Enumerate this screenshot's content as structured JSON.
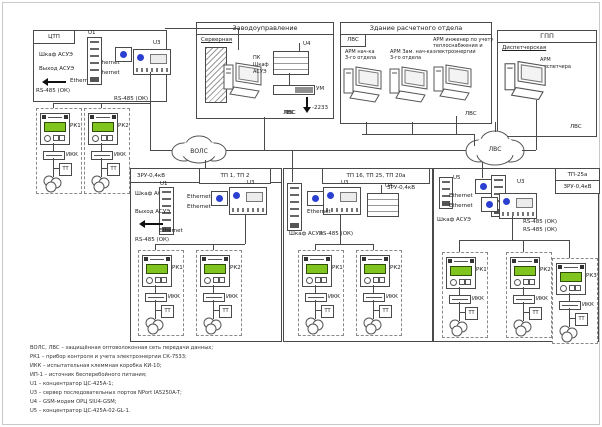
{
  "labels": {
    "ethernet": "Ethernet",
    "rs485": "RS-485 (ОК)",
    "cabinet": "Шкаф АСУЭ",
    "output": "Выход АСУЭ",
    "lvs": "ЛВС",
    "vols": "ВОЛС",
    "ikk": "ИКК",
    "tt": "ТТ",
    "pu3": "ПУ-3",
    "u1": "U1",
    "u3": "U3",
    "u4": "U4",
    "u5": "U5",
    "um": "УМ",
    "antenna": "-2233",
    "rk1": "РК1",
    "rk2": "РК2",
    "rk3": "РК3"
  },
  "boxes": {
    "ctp": {
      "title": "ЦТП"
    },
    "zavod": {
      "title": "Заводоуправление",
      "room": "Серверная",
      "pc1": "ПК",
      "pc2": "Шкаф",
      "pc3": "АСУЭ"
    },
    "raschet": {
      "title": "Здание расчетного отдела",
      "tab": "ЛВС",
      "arm1_l1": "АРМ нач-ка",
      "arm1_l2": "3-го отдела",
      "arm2_l1": "АРМ Зам. нач-ка",
      "arm2_l2": "3-го отдела",
      "arm3_l1": "АРМ инженер по учету",
      "arm3_l2": "теплоснабжения и",
      "arm3_l3": "электроэнергии"
    },
    "gpp": {
      "title": "ГПП",
      "room": "Диспетчерская",
      "arm_l1": "АРМ",
      "arm_l2": "диспетчера"
    },
    "tp12": {
      "title": "ТП 1, ТП 2",
      "zru": "ЗРУ-0,4кВ"
    },
    "tp16": {
      "title": "ТП 16, ТП 25, ТП 20а",
      "zru": "ЗРУ-0,4кВ"
    },
    "tp25": {
      "title": "ТП-25а",
      "zru": "ЗРУ-0,4кВ"
    }
  },
  "legend": {
    "lines": [
      "ВОЛС, ЛВС – защищённая оптоволоконная сеть передачи данных;",
      "РК1 – прибор контроля и учета электроэнергии СК-7533;",
      "ИКК – испытательная клеммная коробка КИ-10;",
      "ИП-1 – источник бесперебойного питания;",
      "U1 – концентратор ЦС-425А-1;",
      "U3 – сервер последовательных портов NPort IA5250A-T;",
      "U4 – GSM-модем ОРЦ SIU4-GSM;",
      "U5 – концентратор ЦС-425А-02-GL-1."
    ]
  },
  "colors": {
    "line": "#4a4a4a",
    "lcd_green": "#7fc41f",
    "logo_blue": "#2b3fd0"
  }
}
